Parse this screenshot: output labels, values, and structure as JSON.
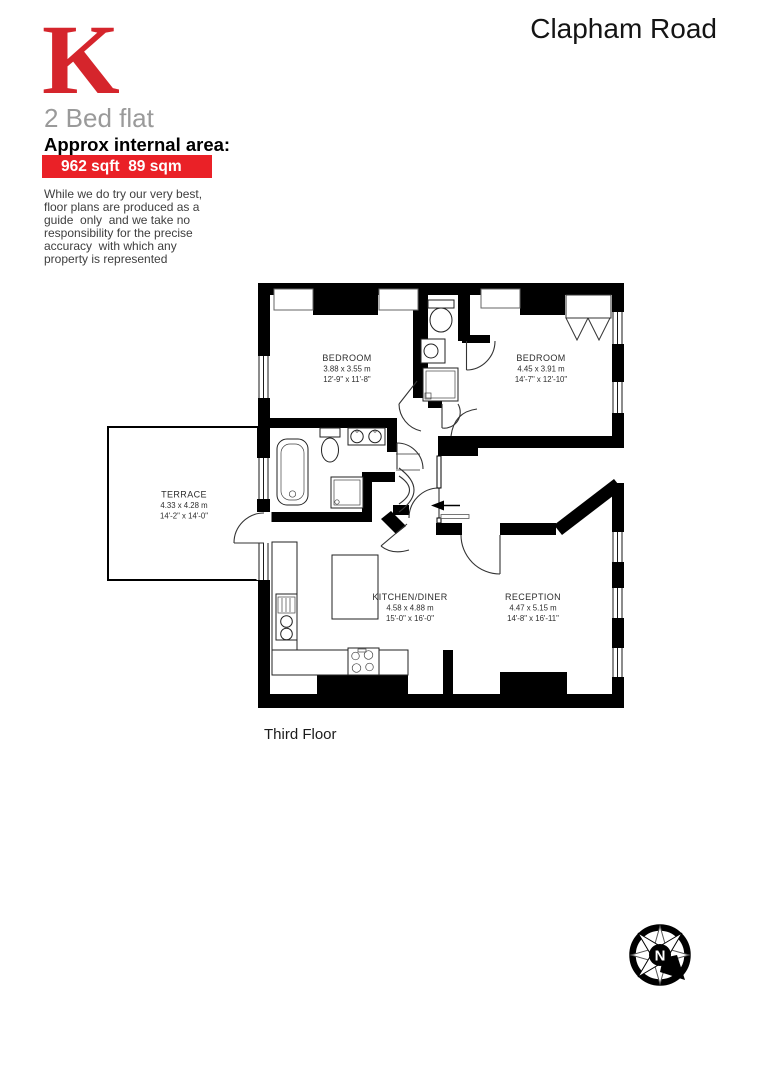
{
  "header": {
    "logo_letter": "K",
    "property_title": "Clapham Road",
    "listing_type": "2 Bed flat",
    "area_heading": "Approx internal area:",
    "area_value": "962 sqft  89 sqm",
    "disclaimer_lines": [
      "While we do try our very best,",
      "floor plans are produced as a",
      "guide  only  and we take no",
      "responsibility for the precise",
      "accuracy  with which any",
      "property is represented"
    ]
  },
  "floorplan": {
    "floor_label": "Third Floor",
    "compass_label": "N",
    "rooms": {
      "bedroom1": {
        "name": "BEDROOM",
        "metric": "3.88 x 3.55 m",
        "imperial": "12'-9\" x 11'-8\""
      },
      "bedroom2": {
        "name": "BEDROOM",
        "metric": "4.45 x 3.91 m",
        "imperial": "14'-7\" x 12'-10\""
      },
      "terrace": {
        "name": "TERRACE",
        "metric": "4.33 x 4.28 m",
        "imperial": "14'-2\" x 14'-0\""
      },
      "kitchen_diner": {
        "name": "KITCHEN/DINER",
        "metric": "4.58 x 4.88 m",
        "imperial": "15'-0\" x 16'-0\""
      },
      "reception": {
        "name": "RECEPTION",
        "metric": "4.47 x 5.15 m",
        "imperial": "14'-8\" x 16'-11\""
      }
    }
  },
  "colors": {
    "brand_red": "#ea2127",
    "logo_red": "#d5252c",
    "subtitle_gray": "#9a9a9a",
    "disclaimer_gray": "#3e3e3e",
    "wall_black": "#000000"
  }
}
